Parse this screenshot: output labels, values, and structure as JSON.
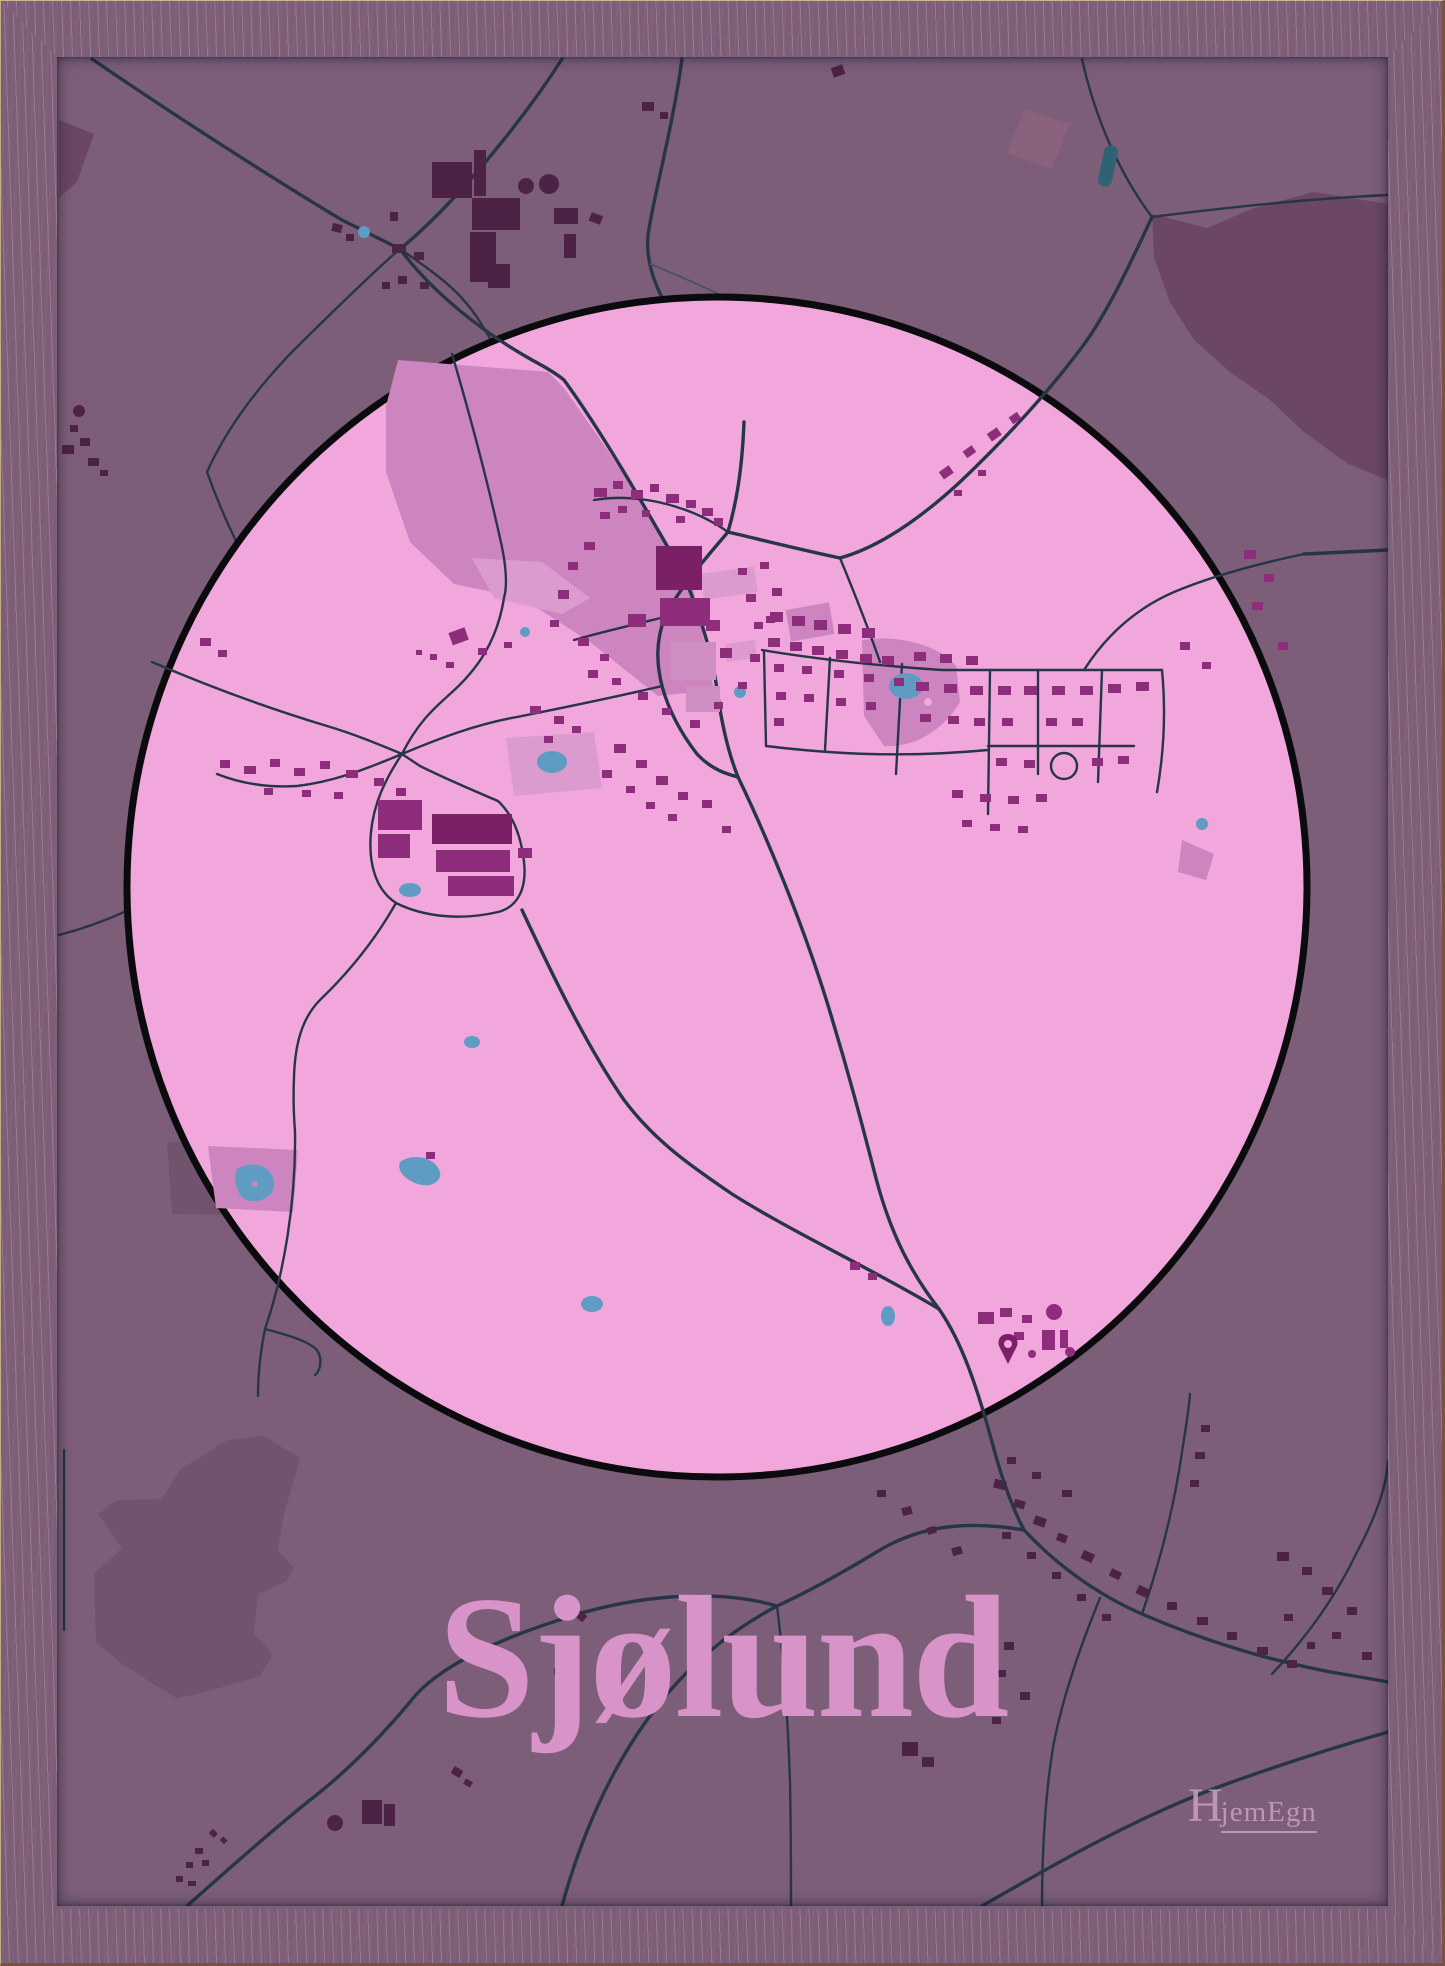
{
  "poster": {
    "title": "Sjølund"
  },
  "branding": {
    "logo_text": "HjemEgn",
    "logo_initial": "H",
    "logo_rest": "jemEgn"
  },
  "palette": {
    "frame-light": "#f6ecd8",
    "frame-mid": "#f0e4c9",
    "frame-dark": "#e7d8b8",
    "frame-edge": "#7a5144",
    "map-bg": "#7d5e78",
    "forest": "#6b4764",
    "patch": "#8a627e",
    "patch-low": "#72536d",
    "road": "#263548",
    "path": "#44536b",
    "circle-fill": "#f1a7db",
    "circle-stroke": "#0b0b0e",
    "field": "#cd85bf",
    "field-light": "#dc9bce",
    "bld-town": "#8e2d7b",
    "bld-town-dark": "#7b1f66",
    "bld-town-light": "#cf8ec2",
    "bld-outer": "#4d2345",
    "pond": "#5f9cc3",
    "water-teal": "#2d6373",
    "title-color": "#d893c9",
    "logo-color": "#c9a0c1"
  }
}
